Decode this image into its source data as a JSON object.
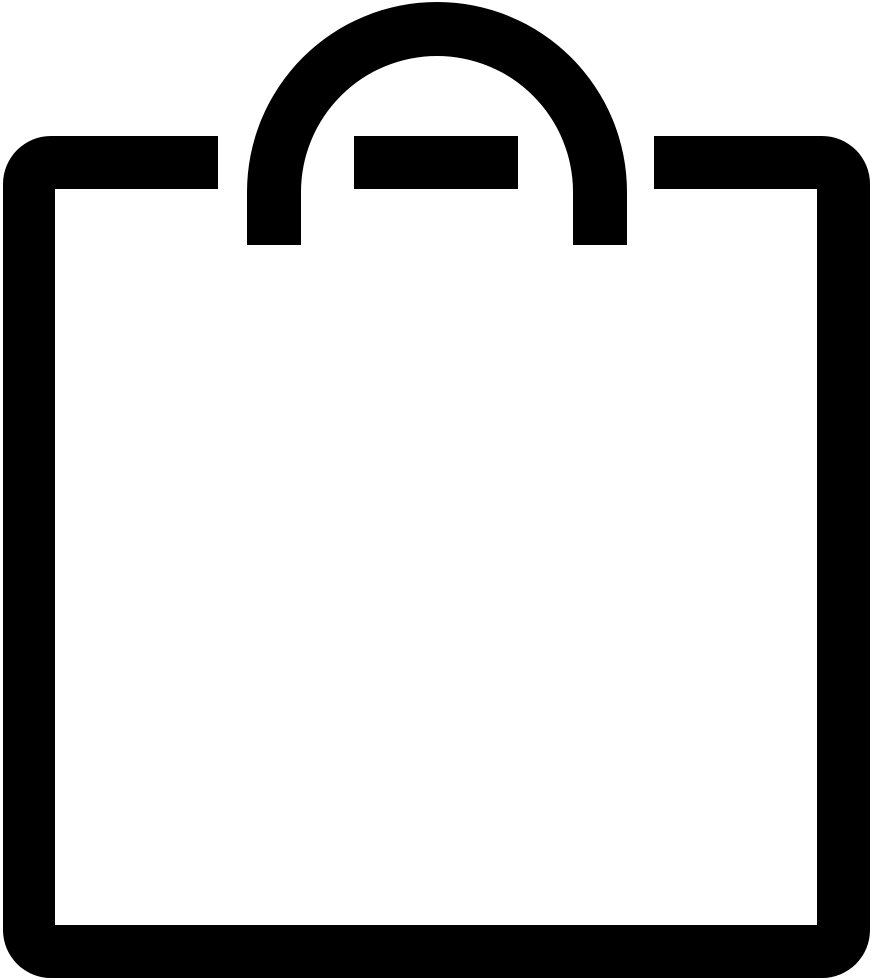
{
  "icon": {
    "name": "shopping-bag-icon",
    "label": "Shopping bag outline icon",
    "glyph_color": "#000000",
    "background_color": "#ffffff"
  }
}
